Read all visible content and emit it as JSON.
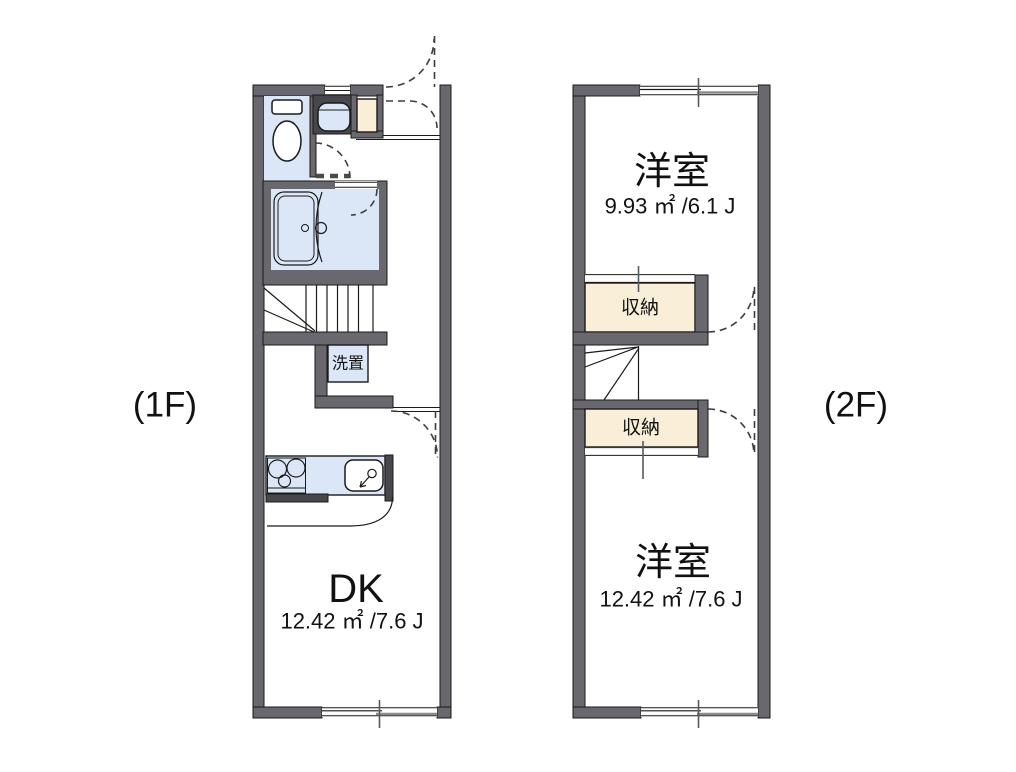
{
  "diagram_title": "apartment-floorplan",
  "palette": {
    "wall_gray": "#68686e",
    "fixture_blue": "#dbe7f7",
    "closet_cream": "#f9efd8",
    "line_black": "#1a1a1a",
    "pane_gray": "#8c8c8c"
  },
  "floor1": {
    "label": "(1F)",
    "rooms": {
      "dk": {
        "name": "DK",
        "area": "12.42 ㎡ /7.6 J"
      },
      "laundry": {
        "name": "洗置"
      }
    }
  },
  "floor2": {
    "label": "(2F)",
    "rooms": {
      "room_top": {
        "name": "洋室",
        "area": "9.93 ㎡ /6.1 J"
      },
      "closet_top": {
        "name": "収納"
      },
      "closet_bottom": {
        "name": "収納"
      },
      "room_bottom": {
        "name": "洋室",
        "area": "12.42 ㎡ /7.6 J"
      }
    }
  }
}
